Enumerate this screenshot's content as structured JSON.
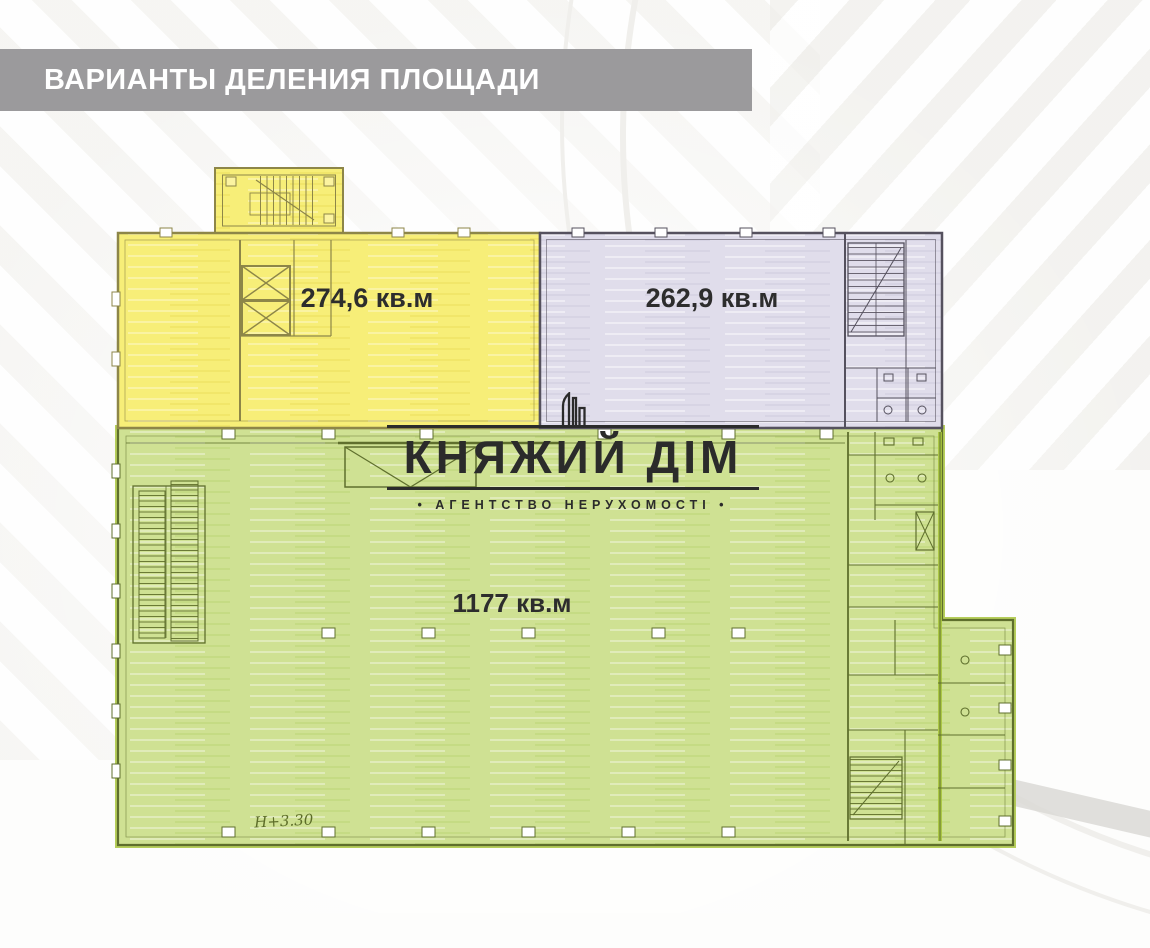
{
  "header": {
    "title": "ВАРИАНТЫ ДЕЛЕНИЯ ПЛОЩАДИ",
    "bg_color": "#9b9a9c",
    "text_color": "#ffffff"
  },
  "zones": [
    {
      "id": "zone-yellow",
      "area_label": "274,6 кв.м",
      "fill": "#f7ee78",
      "outline": "#8d8648"
    },
    {
      "id": "zone-purple",
      "area_label": "262,9 кв.м",
      "fill": "#e0ddeb",
      "outline": "#55515e"
    },
    {
      "id": "zone-green",
      "area_label": "1177 кв.м",
      "fill": "#cfe193",
      "outline": "#5f6f2d",
      "accent": "#a9c53e"
    }
  ],
  "plan": {
    "height_note": "Н+3.30",
    "label_color": "#2d2d2d"
  },
  "logo": {
    "name": "КНЯЖИЙ ДІМ",
    "tagline": "• АГЕНТСТВО НЕРУХОМОСТІ •",
    "color": "#2b2b2b"
  }
}
